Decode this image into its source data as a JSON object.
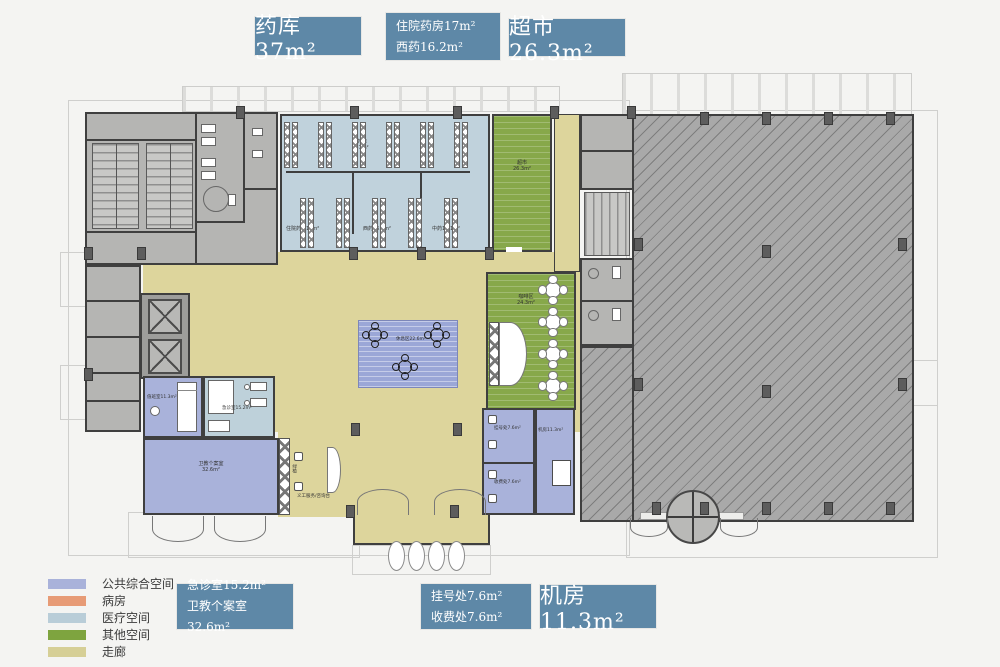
{
  "callouts": {
    "drug_store": "药库37m²",
    "inpatient_pharmacy_l1": "住院药房17m²",
    "inpatient_pharmacy_l2": "西药16.2m²",
    "supermarket": "超市26.3m²",
    "emergency_l1": "急诊室15.2m²",
    "emergency_l2": "卫教个案室32.6m²",
    "registration_l1": "挂号处7.6m²",
    "registration_l2": "收费处7.6m²",
    "machine_room": "机房11.3m²"
  },
  "legend": {
    "items": [
      {
        "label": "公共综合空间",
        "color": "#a9b2da"
      },
      {
        "label": "病房",
        "color": "#e79b76"
      },
      {
        "label": "医疗空间",
        "color": "#b9cdd8"
      },
      {
        "label": "其他空间",
        "color": "#7ea43f"
      },
      {
        "label": "走廊",
        "color": "#d6cf96"
      }
    ]
  },
  "plan_labels": {
    "drug_store_l1": "药库",
    "drug_store_l2": "37m²",
    "inpatient_pharmacy": "住院药房17m²",
    "western_medicine": "西药16.2m²",
    "chinese_medicine": "中药15.1m²",
    "supermarket_l1": "超市",
    "supermarket_l2": "26.3m²",
    "cafe_l1": "咖啡区",
    "cafe_l2": "24.3m²",
    "lounge": "休息区22.6m²",
    "duty_room": "值班室11.3m²",
    "emergency_room": "急诊室15.2m²",
    "health_edu_l1": "卫教个案室",
    "health_edu_l2": "32.6m²",
    "volunteer_desk": "义工服务/咨询台",
    "plants": "绿植",
    "registration": "挂号处7.6m²",
    "cashier": "收费处7.6m²",
    "machine_room": "机房11.3m²"
  },
  "colors": {
    "callout": "#5e88a7",
    "wall": "#3f3f3f",
    "public_purple": "#a9b2da",
    "ward_orange": "#e79b76",
    "medical_blue": "#c0d2dc",
    "other_green": "#87a84a",
    "corridor_yellow": "#ddd59c",
    "hall_gray": "#a9a9a9",
    "lounge_blue": "#9ba7d7"
  }
}
